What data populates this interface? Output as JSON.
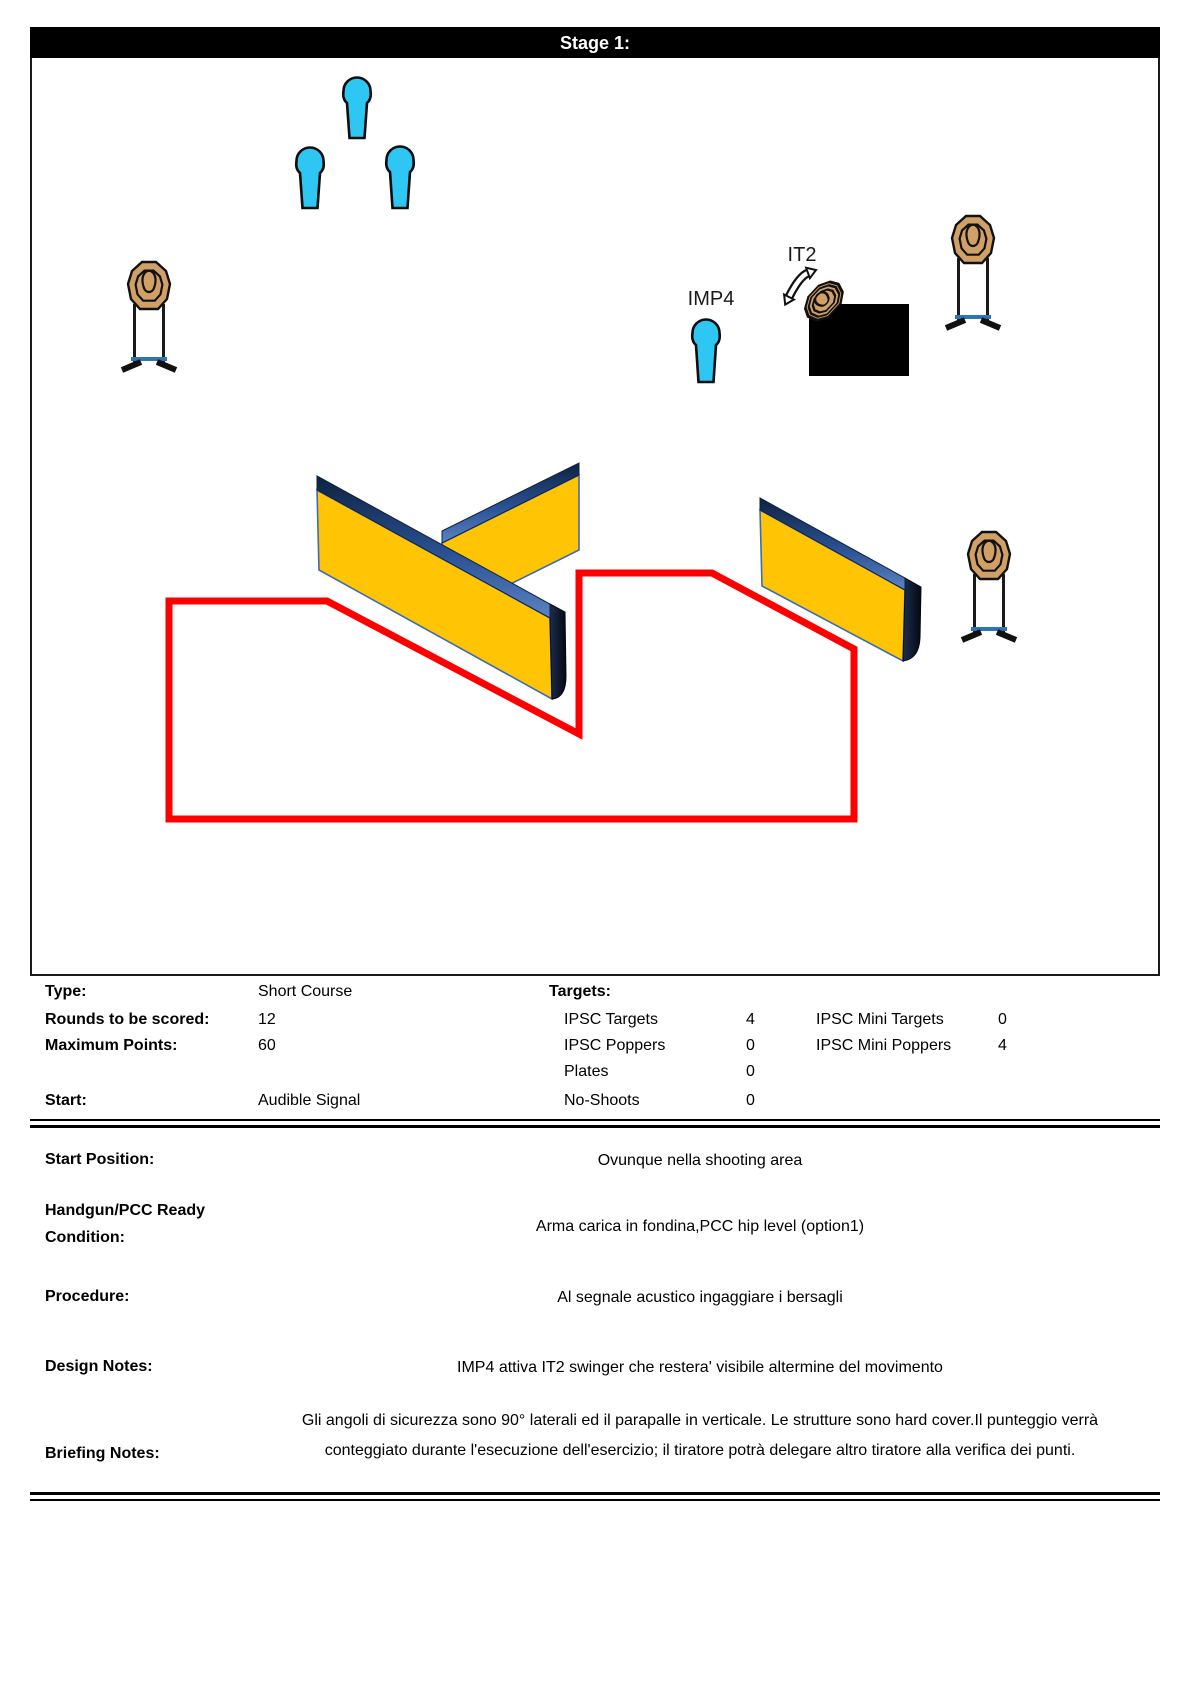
{
  "header": {
    "title": "Stage 1:"
  },
  "info": {
    "type": {
      "label": "Type:",
      "value": "Short Course"
    },
    "rounds": {
      "label": "Rounds to be scored:",
      "value": "12"
    },
    "max_points": {
      "label": "Maximum Points:",
      "value": "60"
    },
    "start": {
      "label": "Start:",
      "value": "Audible Signal"
    },
    "targets_header": "Targets:",
    "counts": {
      "ipsc_targets": {
        "label": "IPSC Targets",
        "value": "4"
      },
      "ipsc_poppers": {
        "label": "IPSC Poppers",
        "value": "0"
      },
      "plates": {
        "label": "Plates",
        "value": "0"
      },
      "no_shoots": {
        "label": "No-Shoots",
        "value": "0"
      },
      "ipsc_mini_targets": {
        "label": "IPSC Mini Targets",
        "value": "0"
      },
      "ipsc_mini_poppers": {
        "label": "IPSC Mini Poppers",
        "value": "4"
      }
    }
  },
  "briefing": {
    "rows": [
      {
        "label": "Start Position:",
        "value": "Ovunque nella shooting area"
      },
      {
        "label": "Handgun/PCC Ready Condition:",
        "value": "Arma carica in fondina,PCC hip level (option1)"
      },
      {
        "label": "Procedure:",
        "value": "Al segnale acustico ingaggiare i bersagli"
      },
      {
        "label": "Design Notes:",
        "value": "IMP4 attiva IT2 swinger che restera' visibile altermine del movimento"
      },
      {
        "label": "Briefing Notes:",
        "value": "Gli angoli di sicurezza sono 90° laterali ed il parapalle in verticale. Le strutture sono hard cover.Il punteggio verrà conteggiato durante l'esecuzione dell'esercizio; il tiratore potrà delegare altro tiratore alla verifica dei punti."
      }
    ]
  },
  "diagram": {
    "colors": {
      "popper": "#2EC6F2",
      "target": "#D0A066",
      "wall_face": "#FFC403",
      "wall_edge": "#3E6CB0",
      "band_dark": "#0E2240",
      "band_mid": "#2A5193",
      "band_light": "#5B84C4",
      "side_dark": "#05080f",
      "side_mid": "#1b2d4f",
      "stand_bar": "#2E75B6",
      "area_line": "#FF0000",
      "hard_cover": "#000000",
      "outline": "#111111"
    },
    "labels": [
      {
        "name": "label-imp4",
        "text": "IMP4",
        "x": 679,
        "y": 247
      },
      {
        "name": "label-it2",
        "text": "IT2",
        "x": 770,
        "y": 203
      }
    ],
    "poppers": [
      {
        "name": "mini-popper-1",
        "cx": 325,
        "top": 21,
        "bottom": 80
      },
      {
        "name": "mini-popper-2",
        "cx": 278,
        "top": 91,
        "bottom": 150
      },
      {
        "name": "mini-popper-3",
        "cx": 368,
        "top": 90,
        "bottom": 150
      },
      {
        "name": "mini-popper-imp4",
        "cx": 674,
        "top": 263,
        "bottom": 324
      }
    ],
    "targets": [
      {
        "name": "mini-target-left",
        "cx": 117,
        "cy": 228,
        "legs_bottom": 305
      },
      {
        "name": "mini-target-right-top",
        "cx": 941,
        "cy": 182,
        "legs_bottom": 263
      },
      {
        "name": "mini-target-right-bottom",
        "cx": 957,
        "cy": 498,
        "legs_bottom": 575
      }
    ],
    "walls": [
      {
        "name": "wall-back",
        "band": [
          [
            410,
            473
          ],
          [
            547,
            405
          ],
          [
            547,
            417
          ],
          [
            410,
            485
          ]
        ],
        "face": [
          [
            410,
            485
          ],
          [
            547,
            417
          ],
          [
            547,
            492
          ],
          [
            410,
            560
          ]
        ]
      },
      {
        "name": "wall-front",
        "band": [
          [
            285,
            418
          ],
          [
            518,
            546
          ],
          [
            518,
            560
          ],
          [
            285,
            432
          ]
        ],
        "face": [
          [
            285,
            432
          ],
          [
            518,
            560
          ],
          [
            520,
            641
          ],
          [
            287,
            512
          ]
        ],
        "side": "M518 546 L533 554 L534 618 Q534 640 520 641 L518 560 Z"
      },
      {
        "name": "wall-right",
        "band": [
          [
            728,
            440
          ],
          [
            873,
            520
          ],
          [
            873,
            532
          ],
          [
            728,
            452
          ]
        ],
        "face": [
          [
            728,
            452
          ],
          [
            873,
            532
          ],
          [
            871,
            603
          ],
          [
            730,
            528
          ]
        ],
        "side": "M873 520 L889 529 L888 580 Q887 601 871 603 L873 532 Z"
      }
    ],
    "hard_cover": {
      "x": 777,
      "y": 246,
      "w": 100,
      "h": 72
    },
    "swinger": {
      "target_cx": 792,
      "target_cy": 243,
      "arrow_cx": 771,
      "arrow_cy": 227
    },
    "shooting_area": [
      [
        137,
        543
      ],
      [
        295,
        543
      ],
      [
        547,
        676
      ],
      [
        547,
        515
      ],
      [
        680,
        515
      ],
      [
        822,
        591
      ],
      [
        822,
        761
      ],
      [
        137,
        761
      ]
    ]
  }
}
